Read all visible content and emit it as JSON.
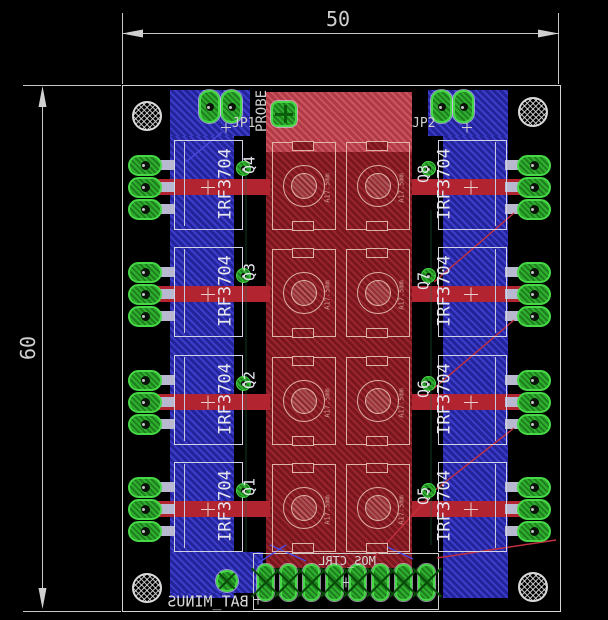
{
  "dimension_annotations": {
    "width": "50",
    "height": "60"
  },
  "silkscreen": {
    "jp1": "JP1",
    "jp2": "JP2",
    "probe": "PROBE",
    "bat_minus": "BAT_MINUS",
    "mos_ctrl": "MOS_CTRL"
  },
  "transistors": [
    {
      "ref": "Q4",
      "part": "IRF3704",
      "side": "left",
      "row": 0
    },
    {
      "ref": "Q3",
      "part": "IRF3704",
      "side": "left",
      "row": 1
    },
    {
      "ref": "Q2",
      "part": "IRF3704",
      "side": "left",
      "row": 2
    },
    {
      "ref": "Q1",
      "part": "IRF3704",
      "side": "left",
      "row": 3
    },
    {
      "ref": "Q8",
      "part": "IRF3704",
      "side": "right",
      "row": 0
    },
    {
      "ref": "Q7",
      "part": "IRF3704",
      "side": "right",
      "row": 1
    },
    {
      "ref": "Q6",
      "part": "IRF3704",
      "side": "right",
      "row": 2
    },
    {
      "ref": "Q5",
      "part": "IRF3704",
      "side": "right",
      "row": 3
    }
  ],
  "capacitors": [
    {
      "label": "A17.5mm",
      "col": 0,
      "row": 0
    },
    {
      "label": "A17.5mm",
      "col": 1,
      "row": 0
    },
    {
      "label": "A17.5mm",
      "col": 0,
      "row": 1
    },
    {
      "label": "A17.5mm",
      "col": 1,
      "row": 1
    },
    {
      "label": "A17.5mm",
      "col": 0,
      "row": 2
    },
    {
      "label": "A17.5mm",
      "col": 1,
      "row": 2
    },
    {
      "label": "A17.5mm",
      "col": 0,
      "row": 3
    },
    {
      "label": "A17.5mm",
      "col": 1,
      "row": 3
    }
  ],
  "connector": {
    "pin_count": 8
  },
  "jumper_pin_count": 2,
  "mounting_hole_count": 4,
  "colors": {
    "copper_top": "#7a161d",
    "copper_bottom": "#2323a0",
    "pad_green": "#2fae2f",
    "silkscreen": "#e6e6ee",
    "dimension": "#c8c8c8",
    "background": "#000000"
  }
}
